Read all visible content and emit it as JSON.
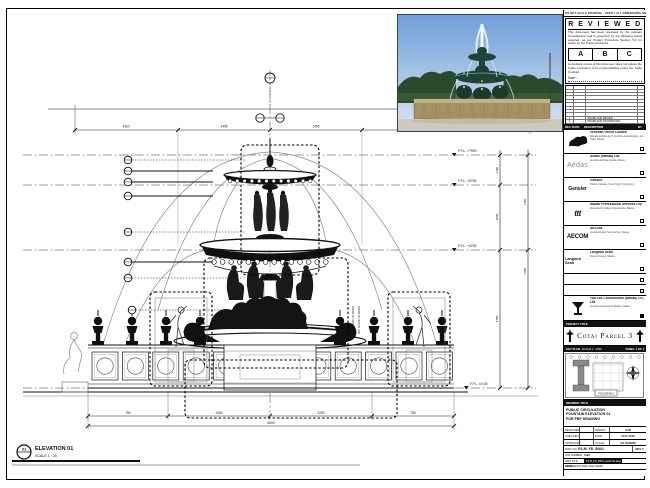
{
  "sheet": {
    "header_note": "DO NOT SCALE DRAWING · VERIFY ALL DIMENSIONS ON SITE · REPORT ANY DISCREPANCY"
  },
  "reviewed": {
    "title": "R E V I E W E D",
    "para1": "This document has been reviewed by the relevant Consultant(s) and is governed by the following status selected, as per Project Procedure Section 5.4 for action by the Trade Contractor.",
    "option_a": "A",
    "option_b": "B",
    "option_c": "C",
    "para2": "Consultant review of this document does not relieve the Trade Contractor of its responsibilities under the Trade Contract.",
    "date_label": "Date :"
  },
  "revisions": {
    "rows": [
      {
        "rev": "1",
        "date": "",
        "description": "ISSUED FOR REVIEW",
        "by": ""
      },
      {
        "rev": "0",
        "date": "",
        "description": "ISSUED FOR INFORMATION",
        "by": ""
      }
    ],
    "header": {
      "rev": "REV.",
      "date": "DATE",
      "description": "DESCRIPTION",
      "by": "BY"
    }
  },
  "companies": [
    {
      "name": "Venetian Orient Limited",
      "addr": "Estrada da Baía de N. Senhora da Esperança, s/n, Taipa, Macau"
    },
    {
      "logo_text": "Aedas",
      "name": "Aedas (Macau) Ltd.",
      "addr": "Avenida da Praia Grande, Macau"
    },
    {
      "logo_text": "Gensler",
      "name": "Gensler",
      "addr": "Harbour Square, Kwun Tong, Hong Kong"
    },
    {
      "logo_text": "ttt",
      "name": "Macau Professional Services Ltd.",
      "addr": "Alameda Dr. Carlos d'Assumpção, Macau"
    },
    {
      "logo_text": "AECOM",
      "name": "AECOM",
      "addr": "Avenida Doutor Sun Yat-Sen, Macau"
    },
    {
      "logo_text": "Langdon Seah",
      "name": "Langdon Seah",
      "addr": "Rua do Campo, Macau"
    }
  ],
  "contractor": {
    "name": "Yau Lee Construction (Macau) Co., Ltd.",
    "addr": "Avenida Comercial de Macau, Macau"
  },
  "project": {
    "label": "PROJECT TITLE",
    "title": "Cotai Parcel 3"
  },
  "key_plan": {
    "label": "KEY PLAN",
    "scale": "SCALE 1 : 1000",
    "panel": "PANEL 1 OF 1",
    "tag": "FOUNTAIN"
  },
  "drawing_title": {
    "label": "DRAWING TITLE",
    "line1": "PUBLIC CIRCULATION",
    "line2": "FOUNTAIN ELEVATION 01",
    "line3": "FOR FRP DRAWING"
  },
  "approval": {
    "designed_label": "DESIGNED",
    "designed": "-",
    "drawn_label": "DRAWN",
    "drawn": "CAD",
    "checked_label": "CHECKED",
    "checked": "-",
    "approved_label": "APPROVED",
    "approved": "-",
    "date_label": "DATE",
    "date": "AUG 2015",
    "scale_label": "SCALE",
    "scale": "AS SHOWN"
  },
  "dwg_info": {
    "dwg_no_label": "DWG NO.",
    "dwg_no": "P3-M_FD_B501",
    "rev_label": "REV",
    "rev": "0",
    "job_label": "JOB NUMBER",
    "job": "3123",
    "file_label": "DWG FILE NAME",
    "file": "P3-M_FD_B501_ELEV-01.dwg",
    "ref_label": "REFERENCE DWG FILE NAME :"
  },
  "drawing": {
    "elevation_tag": {
      "number": "01",
      "title": "ELEVATION 01",
      "scale": "SCALE 1 : 25"
    },
    "levels": {
      "l1": "F.F.L. +7900",
      "l2": "F.F.L. +6750",
      "l3": "F.F.L. +4750",
      "l4": "F.F.L. ±0.00"
    },
    "dims": {
      "t1": "4110",
      "t2": "1495",
      "t3": "1495",
      "t4": "4110",
      "b1": "750",
      "b2": "2250",
      "b3": "2250",
      "b4": "750",
      "b_total": "6000",
      "r1": "1150",
      "r2": "2000",
      "r3": "4750",
      "r4": "3150",
      "r5": "7900"
    },
    "note_frp": "FRP SCOPE OF WORK"
  },
  "colors": {
    "line": "#1a1a1a",
    "water": "#8a8a8a",
    "stamp": "#111111"
  }
}
